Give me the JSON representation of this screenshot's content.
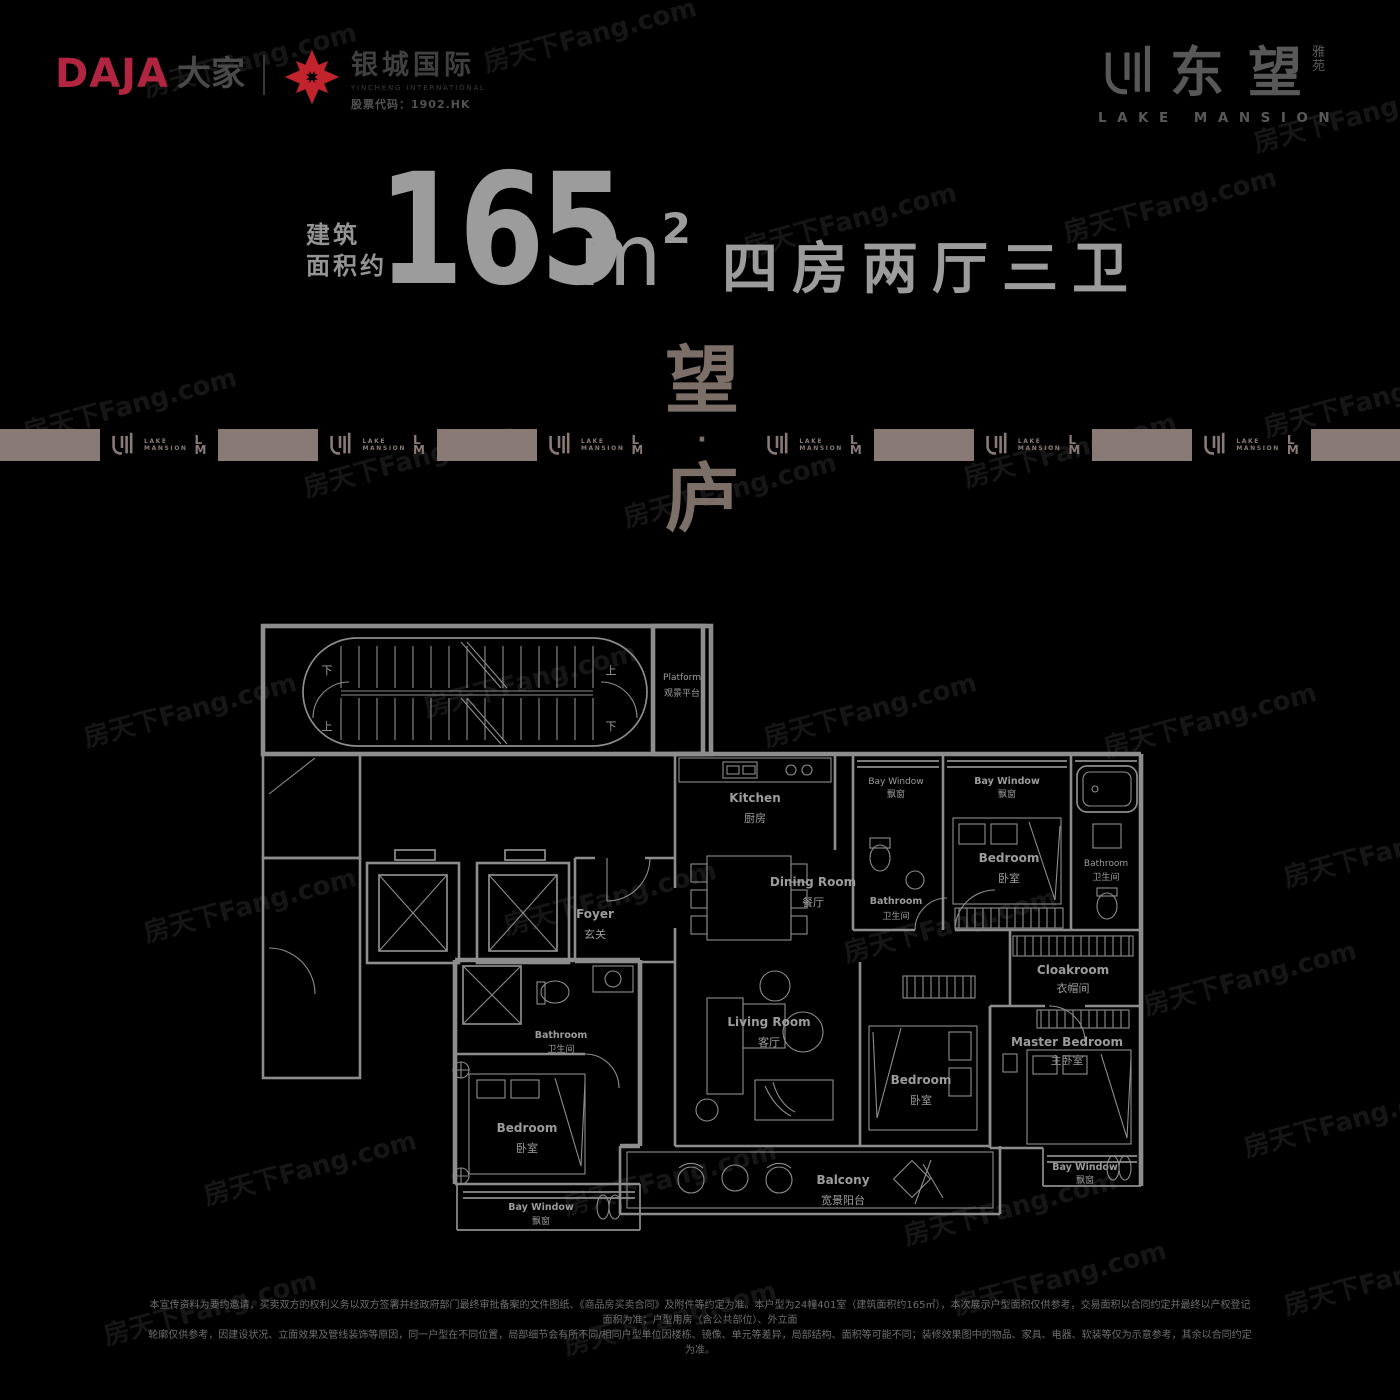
{
  "colors": {
    "background": "#000000",
    "accent_red": "#c2242e",
    "daja_red": "#b12540",
    "band_taupe": "#8a7a76",
    "slogan_brown": "#7c6f67",
    "title_gray": "#9c9c9c",
    "plan_line": "#8d8d8d"
  },
  "header": {
    "daja": {
      "latin": "DAJA",
      "cn": "大家"
    },
    "yincheng": {
      "name": "银城国际",
      "sub": "YINCHENG INTERNATIONAL",
      "stock": "股票代码：1902.HK"
    },
    "brand": {
      "cn1": "东",
      "cn2": "望",
      "suffix1": "雅",
      "suffix2": "苑",
      "en": "LAKE MANSION"
    }
  },
  "headline": {
    "prefix_line1": "建筑",
    "prefix_line2": "面积约",
    "area": "165",
    "unit": "m",
    "unit_sup": "2",
    "rooms": "四房两厅三卫"
  },
  "slogan": {
    "char1": "望",
    "dot": "·",
    "char2": "庐"
  },
  "band": {
    "lake": "LAKE",
    "mansion": "MANSION",
    "l": "L",
    "m": "M"
  },
  "watermark": {
    "text": "房天下Fang.com"
  },
  "floorplan": {
    "stairs": {
      "up": "上",
      "down": "下"
    },
    "labels": {
      "platform": {
        "en": "Platform",
        "cn": "观景平台"
      },
      "foyer": {
        "en": "Foyer",
        "cn": "玄关"
      },
      "kitchen": {
        "en": "Kitchen",
        "cn": "厨房"
      },
      "dining": {
        "en": "Dining Room",
        "cn": "餐厅"
      },
      "living": {
        "en": "Living Room",
        "cn": "客厅"
      },
      "balcony": {
        "en": "Balcony",
        "cn": "宽景阳台"
      },
      "master": {
        "en": "Master Bedroom",
        "cn": "主卧室"
      },
      "cloakroom": {
        "en": "Cloakroom",
        "cn": "衣帽间"
      },
      "bedroom": {
        "en": "Bedroom",
        "cn": "卧室"
      },
      "bathroom": {
        "en": "Bathroom",
        "cn": "卫生间"
      },
      "baywindow": {
        "en": "Bay Window",
        "cn": "飘窗"
      }
    }
  },
  "disclaimer": {
    "line1": "本宣传资料为要约邀请，买卖双方的权利义务以双方签署并经政府部门最终审批备案的文件图纸、《商品房买卖合同》及附件等约定为准。本户型为24幢401室（建筑面积约165㎡），本次展示户型面积仅供参考，交易面积以合同约定并最终以产权登记面积为准；户型用房（含公共部位）、外立面",
    "line2": "轮廓仅供参考，因建设状况、立面效果及管线装饰等原因，同一户型在不同位置，局部细节会有所不同/相同户型单位因楼栋、镜像、单元等差异，局部结构、面积等可能不同；装修效果图中的物品、家具、电器、软装等仅为示意参考，其余以合同约定为准。"
  }
}
